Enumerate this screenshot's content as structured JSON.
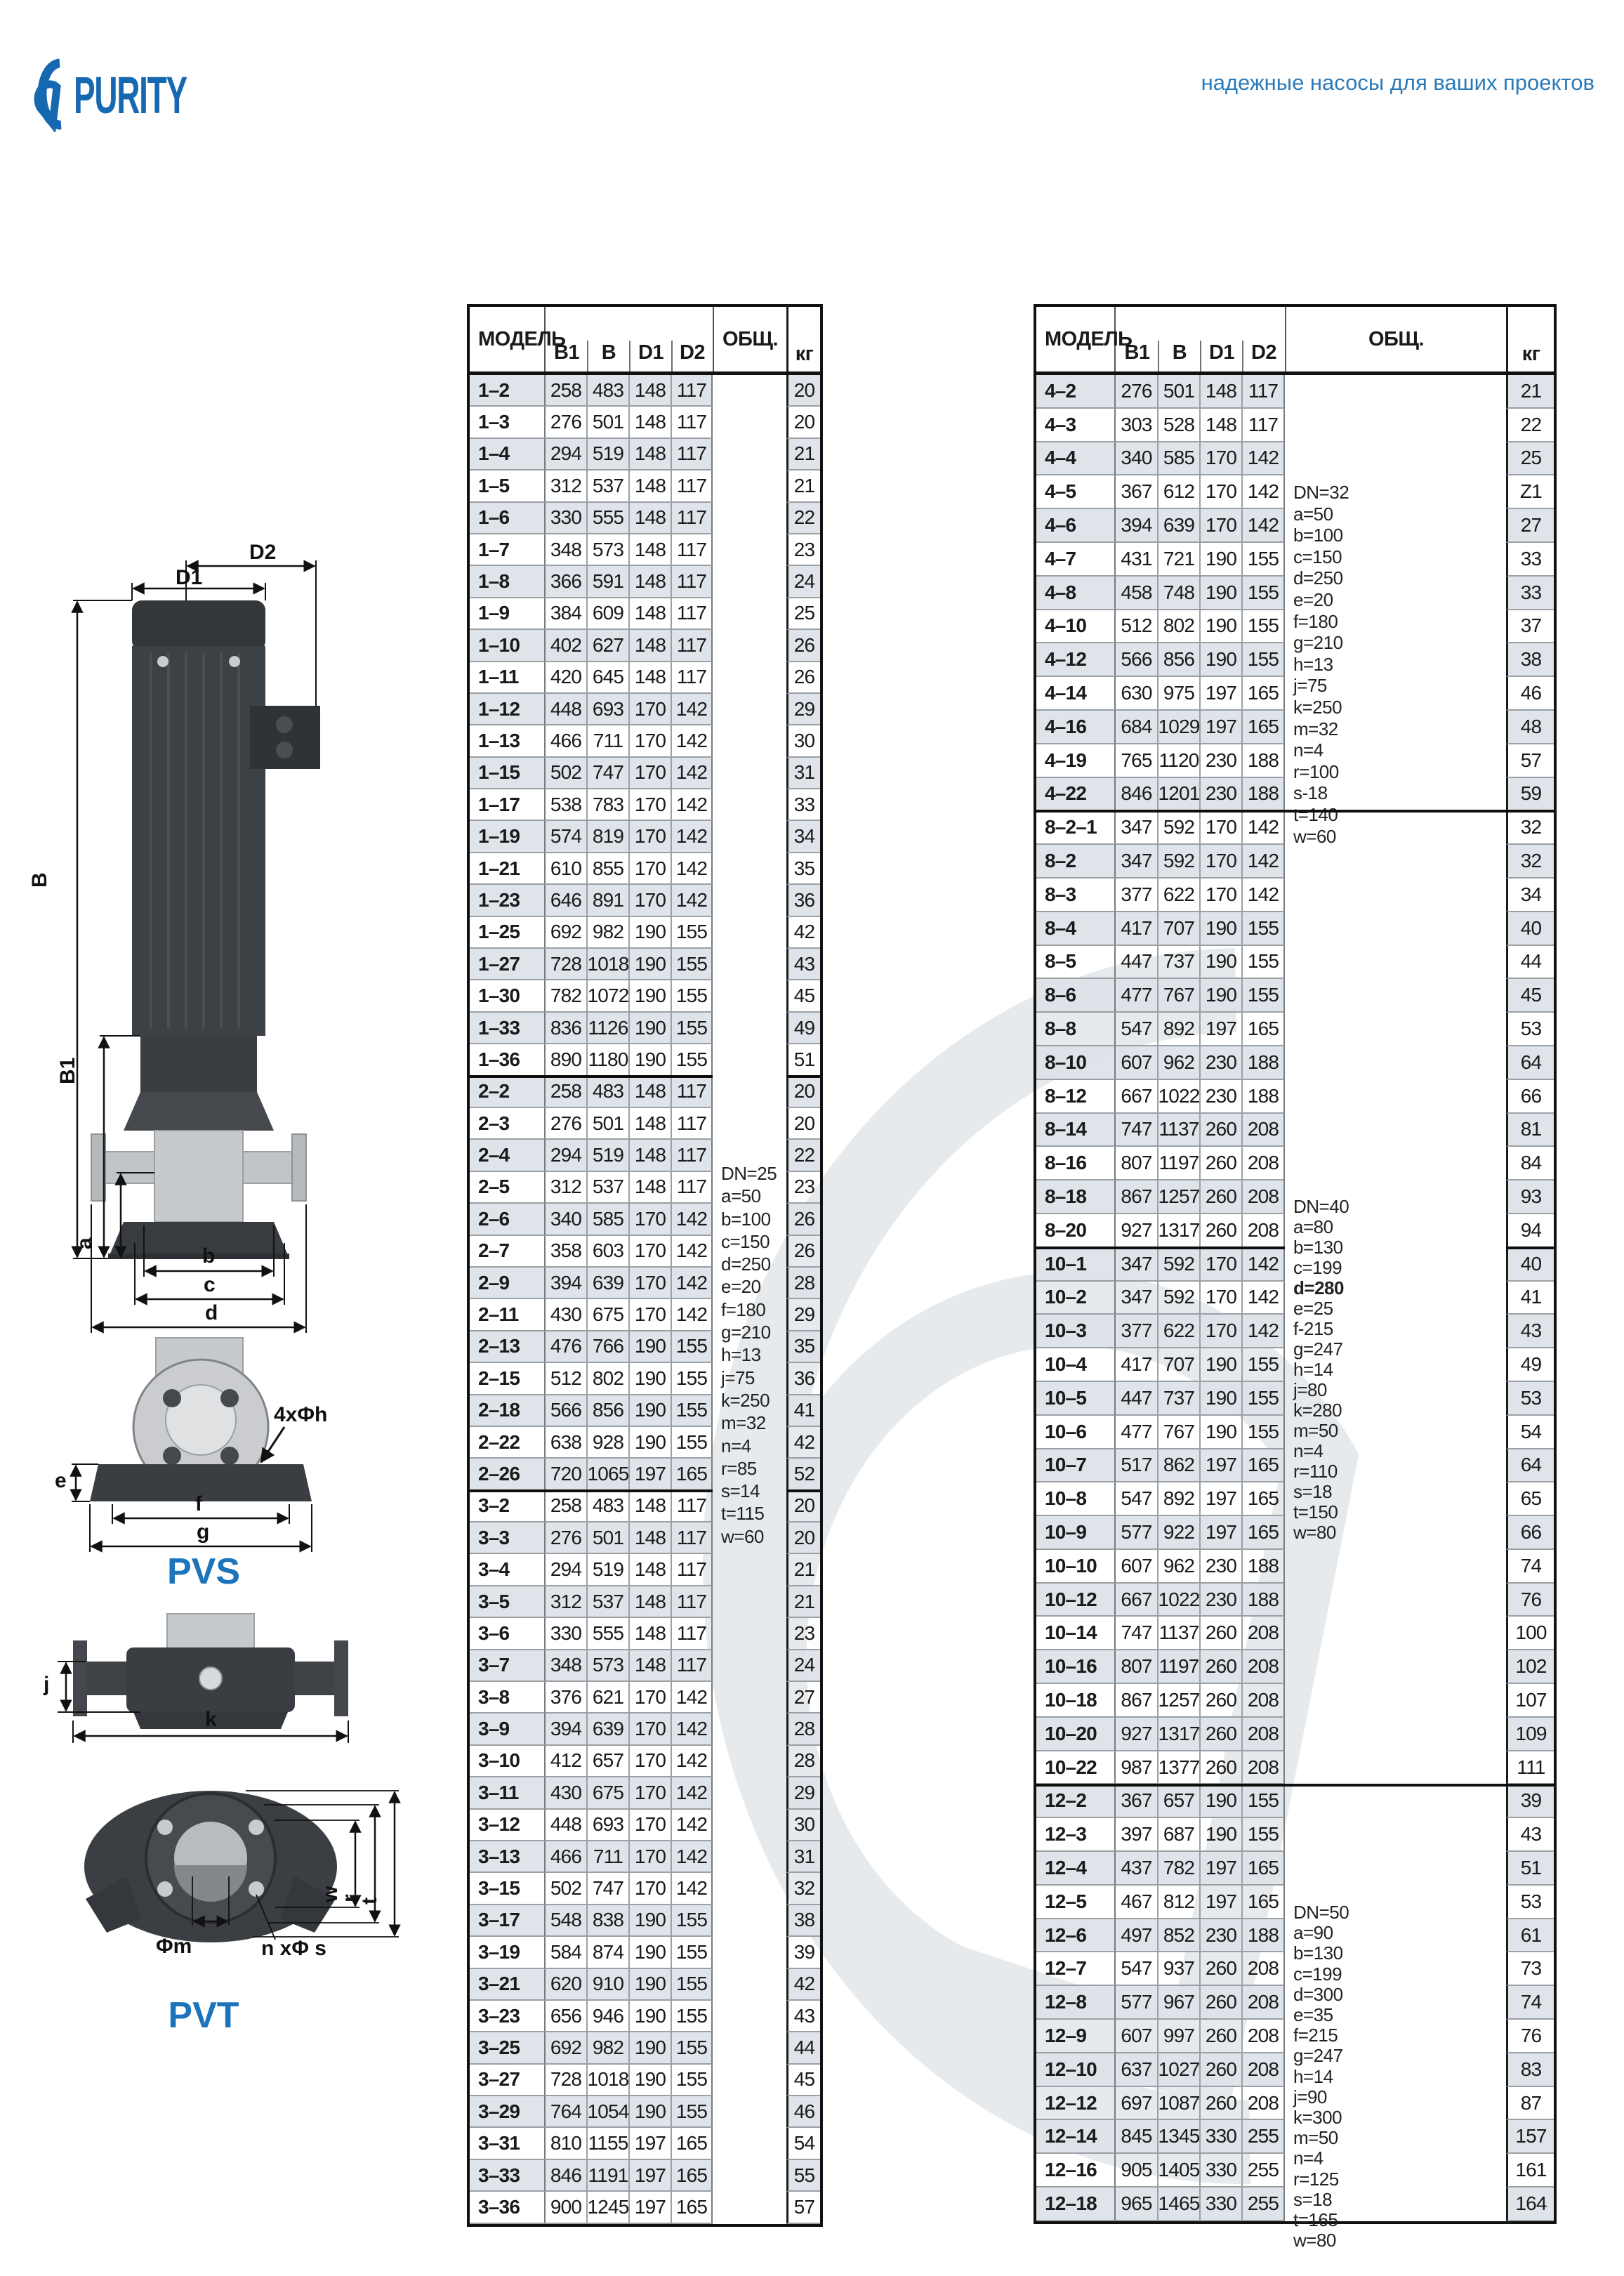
{
  "header": {
    "logo_text": "PURITY",
    "tagline": "надежные насосы для ваших проектов"
  },
  "colors": {
    "brand_blue": "#1668b0",
    "tagline_blue": "#2b7ab8",
    "series_blue": "#1b74bc",
    "row_stripe": "#dde3e7",
    "border_dark": "#111111",
    "border_gray": "#9aa0a4"
  },
  "diagram": {
    "labels": {
      "d1": "D1",
      "d2": "D2",
      "b_total": "B",
      "b1": "B1",
      "a": "a",
      "b": "b",
      "c": "c",
      "d": "d",
      "bolt": "4xΦh",
      "e": "e",
      "f": "f",
      "g": "g",
      "pvs": "PVS",
      "j": "j",
      "k": "k",
      "w": "w",
      "r": "r",
      "t": "t",
      "phi_m": "Φm",
      "n_phi_s": "n xΦ s",
      "pvt": "PVT"
    }
  },
  "tables": [
    {
      "id": "left",
      "columns": {
        "model": "МОДЕЛЬ",
        "b1": "B1",
        "b": "B",
        "d1": "D1",
        "d2": "D2",
        "obsh": "ОБЩ.",
        "kg": "кг"
      },
      "groups": [
        {
          "rows": [
            [
              "1–2",
              258,
              483,
              148,
              117,
              20
            ],
            [
              "1–3",
              276,
              501,
              148,
              117,
              20
            ],
            [
              "1–4",
              294,
              519,
              148,
              117,
              21
            ],
            [
              "1–5",
              312,
              537,
              148,
              117,
              21
            ],
            [
              "1–6",
              330,
              555,
              148,
              117,
              22
            ],
            [
              "1–7",
              348,
              573,
              148,
              117,
              23
            ],
            [
              "1–8",
              366,
              591,
              148,
              117,
              24
            ],
            [
              "1–9",
              384,
              609,
              148,
              117,
              25
            ],
            [
              "1–10",
              402,
              627,
              148,
              117,
              26
            ],
            [
              "1–11",
              420,
              645,
              148,
              117,
              26
            ],
            [
              "1–12",
              448,
              693,
              170,
              142,
              29
            ],
            [
              "1–13",
              466,
              711,
              170,
              142,
              30
            ],
            [
              "1–15",
              502,
              747,
              170,
              142,
              31
            ],
            [
              "1–17",
              538,
              783,
              170,
              142,
              33
            ],
            [
              "1–19",
              574,
              819,
              170,
              142,
              34
            ],
            [
              "1–21",
              610,
              855,
              170,
              142,
              35
            ],
            [
              "1–23",
              646,
              891,
              170,
              142,
              36
            ],
            [
              "1–25",
              692,
              982,
              190,
              155,
              42
            ],
            [
              "1–27",
              728,
              1018,
              190,
              155,
              43
            ],
            [
              "1–30",
              782,
              1072,
              190,
              155,
              45
            ],
            [
              "1–33",
              836,
              1126,
              190,
              155,
              49
            ],
            [
              "1–36",
              890,
              1180,
              190,
              155,
              51
            ]
          ]
        },
        {
          "rows": [
            [
              "2–2",
              258,
              483,
              148,
              117,
              20
            ],
            [
              "2–3",
              276,
              501,
              148,
              117,
              20
            ],
            [
              "2–4",
              294,
              519,
              148,
              117,
              22
            ],
            [
              "2–5",
              312,
              537,
              148,
              117,
              23
            ],
            [
              "2–6",
              340,
              585,
              170,
              142,
              26
            ],
            [
              "2–7",
              358,
              603,
              170,
              142,
              26
            ],
            [
              "2–9",
              394,
              639,
              170,
              142,
              28
            ],
            [
              "2–11",
              430,
              675,
              170,
              142,
              29
            ],
            [
              "2–13",
              476,
              766,
              190,
              155,
              35
            ],
            [
              "2–15",
              512,
              802,
              190,
              155,
              36
            ],
            [
              "2–18",
              566,
              856,
              190,
              155,
              41
            ],
            [
              "2–22",
              638,
              928,
              190,
              155,
              42
            ],
            [
              "2–26",
              720,
              1065,
              197,
              165,
              52
            ]
          ]
        },
        {
          "rows": [
            [
              "3–2",
              258,
              483,
              148,
              117,
              20
            ],
            [
              "3–3",
              276,
              501,
              148,
              117,
              20
            ],
            [
              "3–4",
              294,
              519,
              148,
              117,
              21
            ],
            [
              "3–5",
              312,
              537,
              148,
              117,
              21
            ],
            [
              "3–6",
              330,
              555,
              148,
              117,
              23
            ],
            [
              "3–7",
              348,
              573,
              148,
              117,
              24
            ],
            [
              "3–8",
              376,
              621,
              170,
              142,
              27
            ],
            [
              "3–9",
              394,
              639,
              170,
              142,
              28
            ],
            [
              "3–10",
              412,
              657,
              170,
              142,
              28
            ],
            [
              "3–11",
              430,
              675,
              170,
              142,
              29
            ],
            [
              "3–12",
              448,
              693,
              170,
              142,
              30
            ],
            [
              "3–13",
              466,
              711,
              170,
              142,
              31
            ],
            [
              "3–15",
              502,
              747,
              170,
              142,
              32
            ],
            [
              "3–17",
              548,
              838,
              190,
              155,
              38
            ],
            [
              "3–19",
              584,
              874,
              190,
              155,
              39
            ],
            [
              "3–21",
              620,
              910,
              190,
              155,
              42
            ],
            [
              "3–23",
              656,
              946,
              190,
              155,
              43
            ],
            [
              "3–25",
              692,
              982,
              190,
              155,
              44
            ],
            [
              "3–27",
              728,
              1018,
              190,
              155,
              45
            ],
            [
              "3–29",
              764,
              1054,
              190,
              155,
              46
            ],
            [
              "3–31",
              810,
              1155,
              197,
              165,
              54
            ],
            [
              "3–33",
              846,
              1191,
              197,
              165,
              55
            ],
            [
              "3–36",
              900,
              1245,
              197,
              165,
              57
            ]
          ]
        }
      ],
      "note_blocks": [
        {
          "groups": [
            0,
            1,
            2
          ],
          "lines": [
            "DN=25",
            "a=50",
            "b=100",
            "c=150",
            "d=250",
            "e=20",
            "f=180",
            "g=210",
            "h=13",
            "j=75",
            "k=250",
            "m=32",
            "n=4",
            "r=85",
            "s=14",
            "t=115",
            "w=60"
          ]
        }
      ],
      "bold_line": ""
    },
    {
      "id": "right",
      "columns": {
        "model": "МОДЕЛЬ",
        "b1": "B1",
        "b": "B",
        "d1": "D1",
        "d2": "D2",
        "obsh": "ОБЩ.",
        "kg": "кг"
      },
      "groups": [
        {
          "rows": [
            [
              "4–2",
              276,
              501,
              148,
              117,
              21
            ],
            [
              "4–3",
              303,
              528,
              148,
              117,
              22
            ],
            [
              "4–4",
              340,
              585,
              170,
              142,
              25
            ],
            [
              "4–5",
              367,
              612,
              170,
              142,
              "Z1"
            ],
            [
              "4–6",
              394,
              639,
              170,
              142,
              27
            ],
            [
              "4–7",
              431,
              721,
              190,
              155,
              33
            ],
            [
              "4–8",
              458,
              748,
              190,
              155,
              33
            ],
            [
              "4–10",
              512,
              802,
              190,
              155,
              37
            ],
            [
              "4–12",
              566,
              856,
              190,
              155,
              38
            ],
            [
              "4–14",
              630,
              975,
              197,
              165,
              46
            ],
            [
              "4–16",
              684,
              1029,
              197,
              165,
              48
            ],
            [
              "4–19",
              765,
              1120,
              230,
              188,
              57
            ],
            [
              "4–22",
              846,
              1201,
              230,
              188,
              59
            ]
          ]
        },
        {
          "rows": [
            [
              "8–2–1",
              347,
              592,
              170,
              142,
              32
            ],
            [
              "8–2",
              347,
              592,
              170,
              142,
              32
            ],
            [
              "8–3",
              377,
              622,
              170,
              142,
              34
            ],
            [
              "8–4",
              417,
              707,
              190,
              155,
              40
            ],
            [
              "8–5",
              447,
              737,
              190,
              155,
              44
            ],
            [
              "8–6",
              477,
              767,
              190,
              155,
              45
            ],
            [
              "8–8",
              547,
              892,
              197,
              165,
              53
            ],
            [
              "8–10",
              607,
              962,
              230,
              188,
              64
            ],
            [
              "8–12",
              667,
              1022,
              230,
              188,
              66
            ],
            [
              "8–14",
              747,
              1137,
              260,
              208,
              81
            ],
            [
              "8–16",
              807,
              1197,
              260,
              208,
              84
            ],
            [
              "8–18",
              867,
              1257,
              260,
              208,
              93
            ],
            [
              "8–20",
              927,
              1317,
              260,
              208,
              94
            ]
          ]
        },
        {
          "rows": [
            [
              "10–1",
              347,
              592,
              170,
              142,
              40
            ],
            [
              "10–2",
              347,
              592,
              170,
              142,
              41
            ],
            [
              "10–3",
              377,
              622,
              170,
              142,
              43
            ],
            [
              "10–4",
              417,
              707,
              190,
              155,
              49
            ],
            [
              "10–5",
              447,
              737,
              190,
              155,
              53
            ],
            [
              "10–6",
              477,
              767,
              190,
              155,
              54
            ],
            [
              "10–7",
              517,
              862,
              197,
              165,
              64
            ],
            [
              "10–8",
              547,
              892,
              197,
              165,
              65
            ],
            [
              "10–9",
              577,
              922,
              197,
              165,
              66
            ],
            [
              "10–10",
              607,
              962,
              230,
              188,
              74
            ],
            [
              "10–12",
              667,
              1022,
              230,
              188,
              76
            ],
            [
              "10–14",
              747,
              1137,
              260,
              208,
              100
            ],
            [
              "10–16",
              807,
              1197,
              260,
              208,
              102
            ],
            [
              "10–18",
              867,
              1257,
              260,
              208,
              107
            ],
            [
              "10–20",
              927,
              1317,
              260,
              208,
              109
            ],
            [
              "10–22",
              987,
              1377,
              260,
              208,
              111
            ]
          ]
        },
        {
          "rows": [
            [
              "12–2",
              367,
              657,
              190,
              155,
              39
            ],
            [
              "12–3",
              397,
              687,
              190,
              155,
              43
            ],
            [
              "12–4",
              437,
              782,
              197,
              165,
              51
            ],
            [
              "12–5",
              467,
              812,
              197,
              165,
              53
            ],
            [
              "12–6",
              497,
              852,
              230,
              188,
              61
            ],
            [
              "12–7",
              547,
              937,
              260,
              208,
              73
            ],
            [
              "12–8",
              577,
              967,
              260,
              208,
              74
            ],
            [
              "12–9",
              607,
              997,
              260,
              208,
              76
            ],
            [
              "12–10",
              637,
              1027,
              260,
              208,
              83
            ],
            [
              "12–12",
              697,
              1087,
              260,
              208,
              87
            ],
            [
              "12–14",
              845,
              1345,
              330,
              255,
              157
            ],
            [
              "12–16",
              905,
              1405,
              330,
              255,
              161
            ],
            [
              "12–18",
              965,
              1465,
              330,
              255,
              164
            ]
          ]
        }
      ],
      "note_blocks": [
        {
          "groups": [
            0
          ],
          "lines": [
            "DN=32",
            "a=50",
            "b=100",
            "c=150",
            "d=250",
            "e=20",
            "f=180",
            "g=210",
            "h=13",
            "j=75",
            "k=250",
            "m=32",
            "n=4",
            "r=100",
            "s-18",
            "t=140",
            "w=60"
          ]
        },
        {
          "groups": [
            1,
            2
          ],
          "lines": [
            "DN=40",
            "a=80",
            "b=130",
            "c=199",
            "d=280",
            "e=25",
            "f-215",
            "g=247",
            "h=14",
            "j=80",
            "k=280",
            "m=50",
            "n=4",
            "r=110",
            "s=18",
            "t=150",
            "w=80"
          ]
        },
        {
          "groups": [
            3
          ],
          "lines": [
            "DN=50",
            "a=90",
            "b=130",
            "c=199",
            "d=300",
            "e=35",
            "f=215",
            "g=247",
            "h=14",
            "j=90",
            "k=300",
            "m=50",
            "n=4",
            "r=125",
            "s=18",
            "t=165",
            "w=80"
          ]
        }
      ],
      "bold_line": "d=280"
    }
  ]
}
